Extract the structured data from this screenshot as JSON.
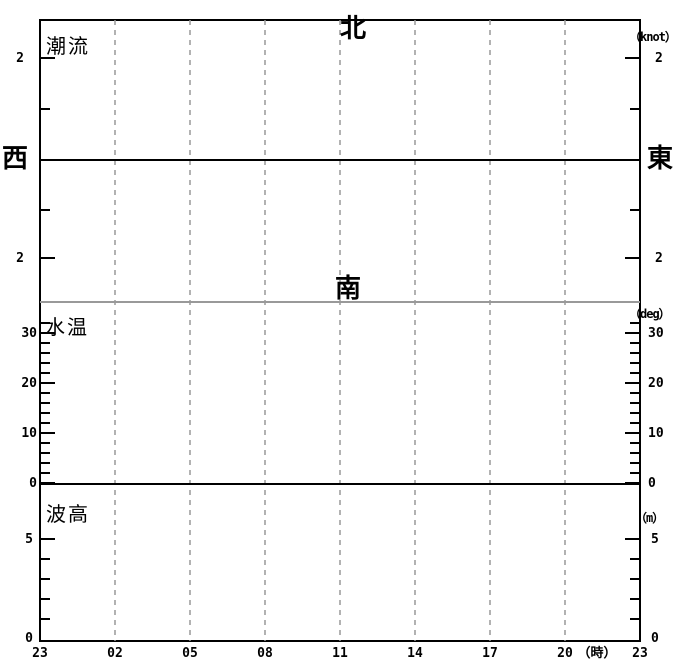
{
  "colors": {
    "background": "#ffffff",
    "axis": "#000000",
    "grid": "#999999",
    "separator": "#999999",
    "text": "#000000"
  },
  "layout": {
    "width": 680,
    "height": 660,
    "plot": {
      "left": 40,
      "top": 20,
      "right": 640,
      "bottom": 641
    },
    "grid_x": [
      115,
      190,
      265,
      340,
      415,
      490,
      565
    ],
    "tick": {
      "major_len": 14,
      "minor_len": 9
    }
  },
  "panels": {
    "current": {
      "label": "潮流",
      "unit": "（knot）",
      "directions": {
        "north": "北",
        "south": "南",
        "west": "西",
        "east": "東"
      },
      "zero_y": 160,
      "major_ticks": [
        {
          "label": "2",
          "y": 58
        },
        {
          "label": "2",
          "y": 258
        }
      ],
      "minor_ticks": [
        109,
        210
      ],
      "label_left_x": 24,
      "label_right_x": 655
    },
    "temperature": {
      "label": "水温",
      "unit": "（deg）",
      "top_separator_y": 302,
      "zero_y": 484,
      "major_ticks": [
        {
          "label": "30",
          "y": 333
        },
        {
          "label": "20",
          "y": 383
        },
        {
          "label": "10",
          "y": 433
        },
        {
          "label": "0",
          "y": 483
        }
      ],
      "minor_ticks": [
        323,
        343,
        353,
        363,
        373,
        393,
        403,
        413,
        423,
        443,
        453,
        463,
        473
      ],
      "label_left_x": 37,
      "label_right_x": 648
    },
    "wave": {
      "label": "波高",
      "unit": "（m）",
      "major_ticks": [
        {
          "label": "5",
          "y": 539
        }
      ],
      "minor_ticks": [
        559,
        579,
        599,
        619
      ],
      "extra_labels": [
        {
          "label": "0",
          "y": 638
        }
      ],
      "label_left_x": 33,
      "label_right_x": 651
    }
  },
  "x_axis": {
    "unit": "（時）",
    "unit_x": 597,
    "baseline_y": 657,
    "labels": [
      {
        "t": "23",
        "x": 40
      },
      {
        "t": "02",
        "x": 115
      },
      {
        "t": "05",
        "x": 190
      },
      {
        "t": "08",
        "x": 265
      },
      {
        "t": "11",
        "x": 340
      },
      {
        "t": "14",
        "x": 415
      },
      {
        "t": "17",
        "x": 490
      },
      {
        "t": "20",
        "x": 565
      },
      {
        "t": "23",
        "x": 640
      }
    ]
  },
  "chart_data": [
    {
      "type": "line",
      "title": "潮流",
      "ylabel": "（knot）",
      "xlabel": "（時）",
      "x_tick_labels": [
        "23",
        "02",
        "05",
        "08",
        "11",
        "14",
        "17",
        "20",
        "23"
      ],
      "y_axis": {
        "zero_centered": true,
        "labeled_tick_values": [
          2,
          2
        ],
        "minor_tick_values": [
          1,
          1
        ],
        "up_direction": "北",
        "down_direction": "南",
        "left_end_direction": "西",
        "right_end_direction": "東"
      },
      "ylim": [
        -2.8,
        2.8
      ],
      "grid": "vertical-dashed",
      "series": []
    },
    {
      "type": "line",
      "title": "水温",
      "ylabel": "（deg）",
      "xlabel": "（時）",
      "x_tick_labels": [
        "23",
        "02",
        "05",
        "08",
        "11",
        "14",
        "17",
        "20",
        "23"
      ],
      "y_ticks_labeled": [
        0,
        10,
        20,
        30
      ],
      "y_minor_step": 2,
      "ylim": [
        0,
        36
      ],
      "grid": "vertical-dashed",
      "series": []
    },
    {
      "type": "line",
      "title": "波高",
      "ylabel": "（m）",
      "xlabel": "（時）",
      "x_tick_labels": [
        "23",
        "02",
        "05",
        "08",
        "11",
        "14",
        "17",
        "20",
        "23"
      ],
      "y_ticks_labeled": [
        0,
        5
      ],
      "y_minor_step": 1,
      "ylim": [
        0,
        7.8
      ],
      "grid": "vertical-dashed",
      "series": []
    }
  ]
}
